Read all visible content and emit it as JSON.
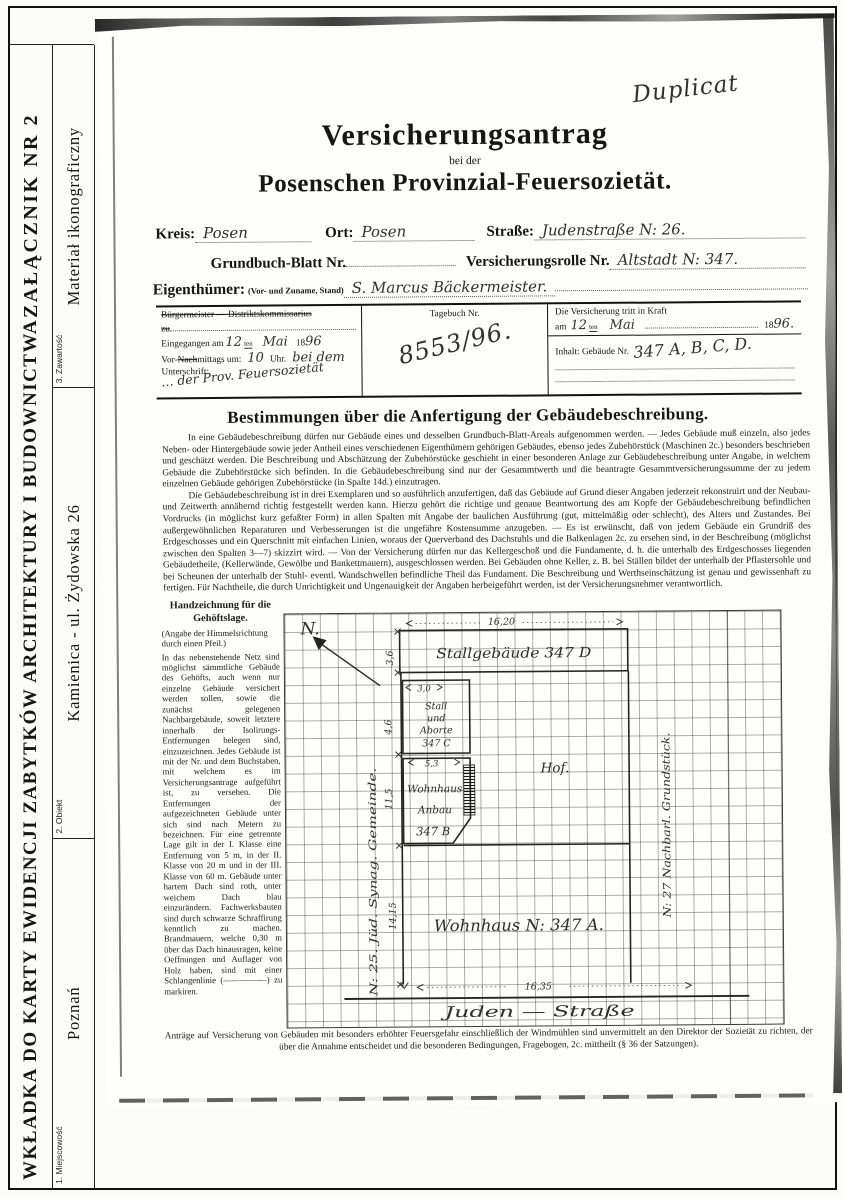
{
  "card": {
    "title": "WKŁADKA DO KARTY EWIDENCJI ZABYTKÓW ARCHITEKTURY I BUDOWNICTWA",
    "annex": "ZAŁĄCZNIK NR 2",
    "field1_label": "1. Miejscowość",
    "field1_value": "Poznań",
    "field2_label": "2. Obiekt",
    "field2_value": "Kamienica - ul. Żydowska 26",
    "field3_label": "3. Zawartość",
    "field3_value": "Materiał ikonograficzny"
  },
  "form": {
    "duplicate_note": "Duplicat",
    "title": "Versicherungsantrag",
    "subtitle": "bei der",
    "organization": "Posenschen Provinzial-Feuersozietät.",
    "kreis_label": "Kreis:",
    "kreis_value": "Posen",
    "ort_label": "Ort:",
    "ort_value": "Posen",
    "strasse_label": "Straße:",
    "strasse_value": "Judenstraße N: 26.",
    "grundbuch_label": "Grundbuch-Blatt Nr.",
    "rolle_label": "Versicherungsrolle Nr.",
    "rolle_value": "Altstadt N: 347.",
    "owner_label": "Eigenthümer:",
    "owner_sublabel": "(Vor- und Zuname, Stand)",
    "owner_value": "S. Marcus Bäckermeister.",
    "office": {
      "authority_line": "Bürgermeister — Distriktskommissarius",
      "authority_line2": "zu",
      "received_label": "Eingegangen am",
      "received_day": "12",
      "received_suffix": "ten",
      "received_month": "Mai",
      "year_prefix": "18",
      "received_year": "96",
      "time_label_pre": "Vor-",
      "time_label_strike": "Nach",
      "time_label_post": "mittags um:",
      "time_value": "10",
      "time_unit": "Uhr.",
      "time_note": "bei dem",
      "signature_label": "Unterschrift:",
      "signature_value": "… der Prov. Feuersozietät",
      "journal_label": "Tagebuch Nr.",
      "journal_value": "8553/96.",
      "effective_label": "Die Versicherung tritt in Kraft",
      "effective_am": "am",
      "effective_day": "12",
      "effective_suffix": "ten",
      "effective_month": "Mai",
      "effective_year_prefix": "18",
      "effective_year": "96.",
      "content_label": "Inhalt: Gebäude Nr.",
      "content_value": "347 A, B, C, D."
    },
    "rules": {
      "heading": "Bestimmungen über die Anfertigung der Gebäudebeschreibung.",
      "para1": "In eine Gebäudebeschreibung dürfen nur Gebäude eines und desselben Grundbuch-Blatt-Areals aufgenommen werden. — Jedes Gebäude muß einzeln, also jedes Neben- oder Hintergebäude sowie jeder Antheil eines verschiedenen Eigenthümern gehörigen Gebäudes, ebenso jedes Zubehörstück (Maschinen 2c.) besonders beschrieben und geschätzt werden. Die Beschreibung und Abschätzung der Zubehörstücke geschieht in einer besonderen Anlage zur Gebäudebeschreibung unter Angabe, in welchem Gebäude die Zubehörstücke sich befinden. In die Gebäudebeschreibung sind nur der Gesammtwerth und die beantragte Gesammtversicherungssumme der zu jedem einzelnen Gebäude gehörigen Zubehörstücke (in Spalte 14d.) einzutragen.",
      "para2": "Die Gebäudebeschreibung ist in drei Exemplaren und so ausführlich anzufertigen, daß das Gebäude auf Grund dieser Angaben jederzeit rekonstruirt und der Neubau- und Zeitwerth annähernd richtig festgestellt werden kann. Hierzu gehört die richtige und genaue Beantwortung des am Kopfe der Gebäudebeschreibung befindlichen Vordrucks (in möglichst kurz gefaßter Form) in allen Spalten mit Angabe der baulichen Ausführung (gut, mittelmäßig oder schlecht), des Alters und Zustandes. Bei außergewöhnlichen Reparaturen und Verbesserungen ist die ungefähre Kostensumme anzugeben. — Es ist erwünscht, daß von jedem Gebäude ein Grundriß des Erdgeschosses und ein Querschnitt mit einfachen Linien, woraus der Querverband des Dachstuhls und die Balkenlagen 2c. zu ersehen sind, in der Beschreibung (möglichst zwischen den Spalten 3—7) skizzirt wird. — Von der Versicherung dürfen nur das Kellergeschoß und die Fundamente, d. h. die unterhalb des Erdgeschosses liegenden Gebäudetheile, (Kellerwände, Gewölbe und Bankettmauern), ausgeschlossen werden. Bei Gebäuden ohne Keller, z. B. bei Ställen bildet der unterhalb der Pflastersohle und bei Scheunen der unterhalb der Stuhl- eventl. Wandschwellen befindliche Theil das Fundament. Die Beschreibung und Werthseinschätzung ist genau und gewissenhaft zu fertigen. Für Nachtheile, die durch Unrichtigkeit und Ungenauigkeit der Angaben herbeigeführt werden, ist der Versicherungsnehmer verantwortlich."
    },
    "sketch": {
      "heading": "Handzeichnung für die Gehöftslage.",
      "note": "(Angabe der Himmelsrichtung durch einen Pfeil.)",
      "body": "In das nebenstehende Netz sind möglichst sämmtliche Gebäude des Gehöfts, auch wenn nur einzelne Gebäude versichert werden sollen, sowie die zunächst gelegenen Nachbargebäude, soweit letztere innerhalb der Isolirungs-Entfernungen belegen sind, einzuzeichnen. Jedes Gebäude ist mit der Nr. und dem Buchstaben, mit welchem es im Versicherungsantrage aufgeführt ist, zu versehen. Die Entfernungen der aufgezeichneten Gebäude unter sich sind nach Metern zu bezeichnen. Für eine getrennte Lage gilt in der I. Klasse eine Entfernung von 5 m, in der II. Klasse von 20 m und in der III. Klasse von 60 m. Gebäude unter hartem Dach sind roth, unter weichem Dach blau einzurändern. Fachwerksbauten sind durch schwarze Schraffirung kenntlich zu machen. Brandmauern, welche 0,30 m über das Dach hinausragen, keine Oeffnungen und Auflager von Holz haben, sind mit einer Schlangenlinie (—————) zu markiren.",
      "north": "N.",
      "dim_top": "16,20",
      "stall_label": "Stallgebäude 347 D",
      "dim_36": "3,6",
      "dim_30": "3,0",
      "shed1": "Stall",
      "shed2": "und",
      "shed3": "Aborte",
      "shed4": "347 C",
      "dim_46": "4,6",
      "dim_53": "5,3",
      "anbau1": "Wohnhaus",
      "anbau2": "Anbau",
      "anbau3": "347 B",
      "dim_115": "11,5",
      "hof": "Hof.",
      "left_neighbor": "N: 25. Jüd. Synag. Gemeinde.",
      "right_neighbor": "N: 27 Nachbarl. Grundstück.",
      "dim_1415": "14,15",
      "house_label": "Wohnhaus N: 347 A.",
      "dim_bottom": "16,35",
      "street": "Juden — Straße"
    },
    "footer": "Anträge auf Versicherung von Gebäuden mit besonders erhöhter Feuersgefahr einschließlich der Windmühlen sind unvermittelt an den Direktor der Sozietät zu richten, der über die Annahme entscheidet und die besonderen Bedingungen, Fragebogen, 2c. mittheilt (§ 36 der Satzungen)."
  }
}
